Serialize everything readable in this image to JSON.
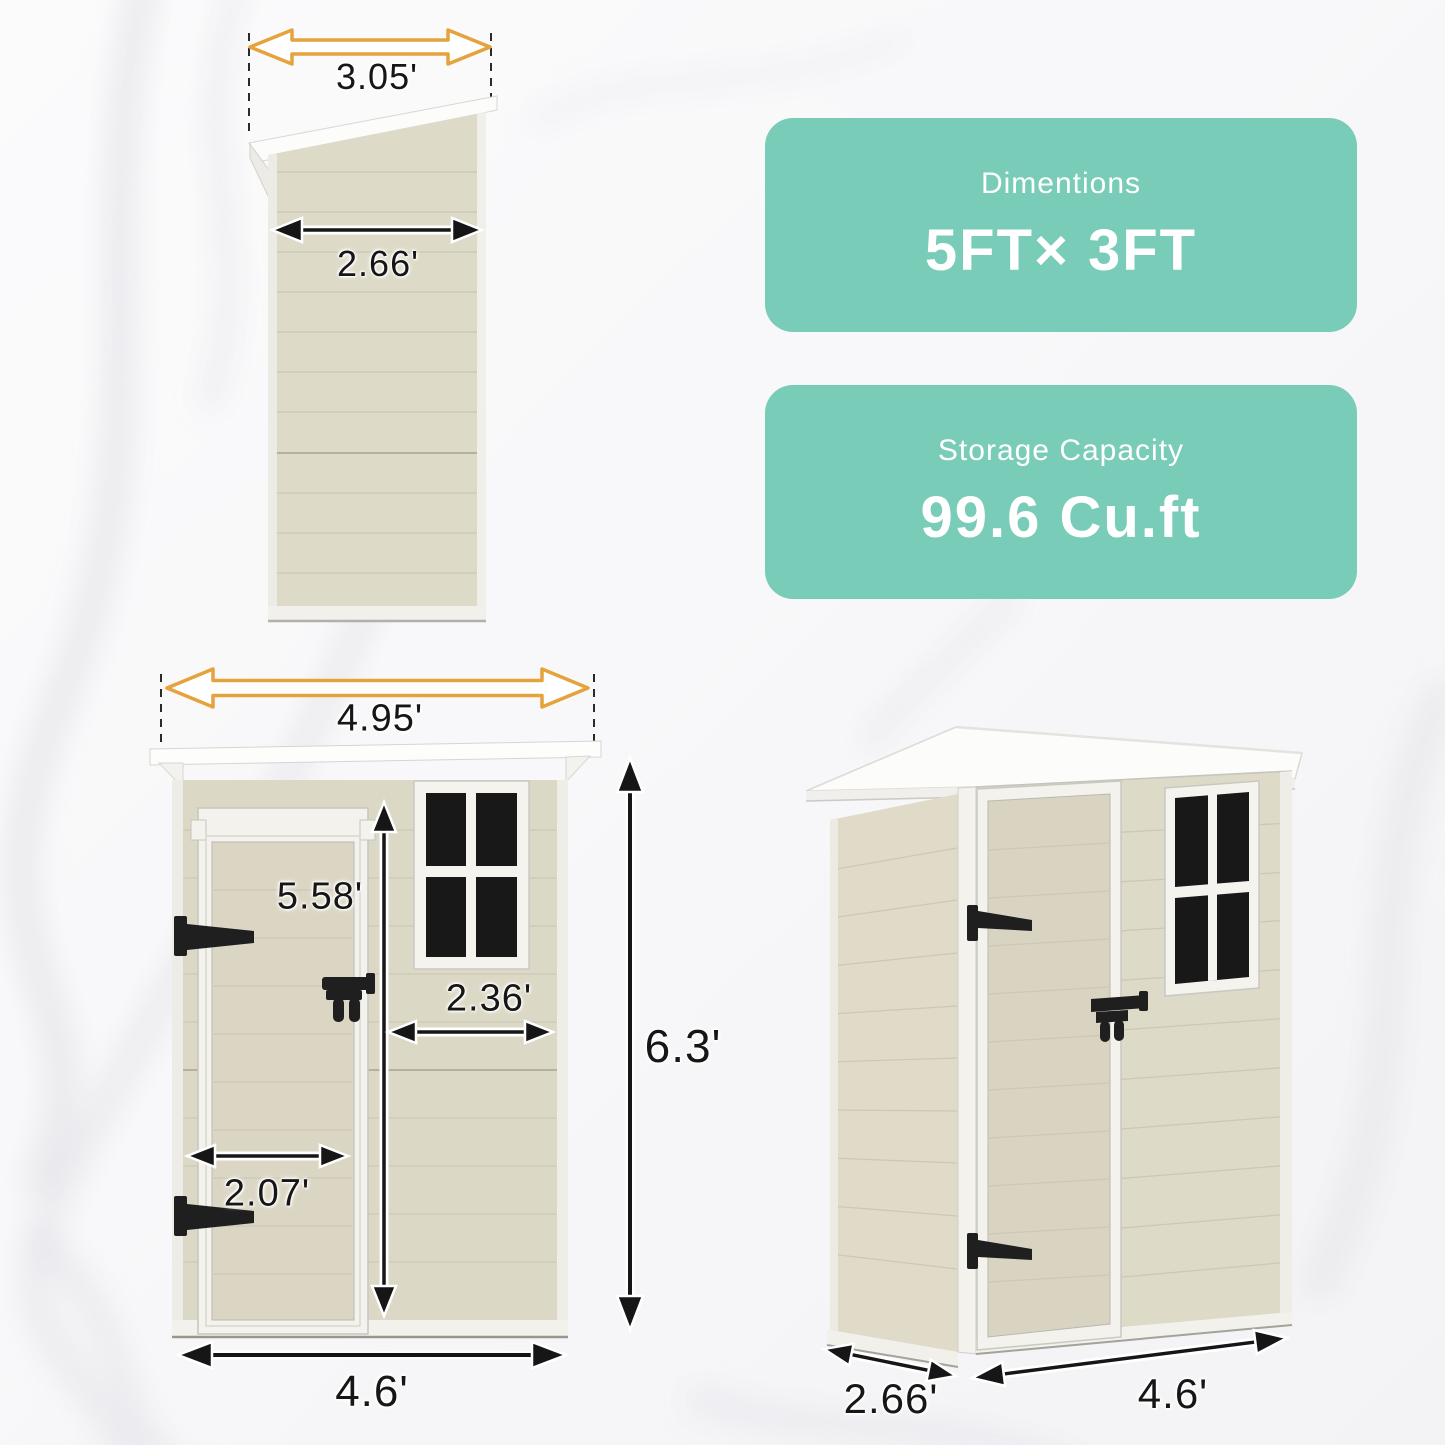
{
  "cards": [
    {
      "title": "Dimentions",
      "value": "5FT× 3FT"
    },
    {
      "title": "Storage Capacity",
      "value": "99.6 Cu.ft"
    }
  ],
  "views": {
    "side": {
      "roof_width": "3.05'",
      "wall_width": "2.66'"
    },
    "front": {
      "roof_width": "4.95'",
      "door_height": "5.58'",
      "window_width": "2.36'",
      "door_width": "2.07'",
      "overall_height": "6.3'",
      "base_width": "4.6'"
    },
    "perspective": {
      "depth": "2.66'",
      "width": "4.6'"
    }
  },
  "colors": {
    "card_teal": "#79ccb7",
    "card_text": "#ffffff",
    "arrow_yellow": "#e4a33c",
    "dimension_black": "#161616",
    "wall_beige": "#dedac8",
    "frame_white": "#f3f2ed",
    "window_pane": "#181818"
  }
}
